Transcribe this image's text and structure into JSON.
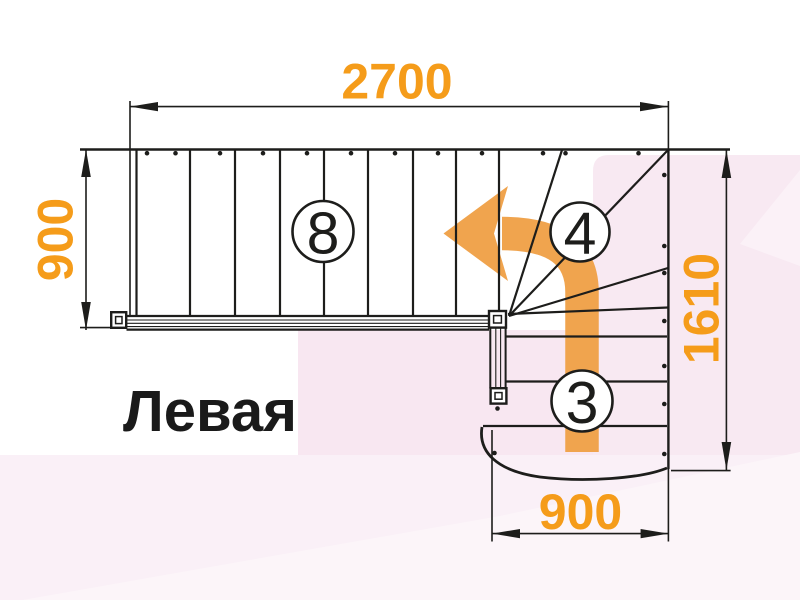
{
  "diagram": {
    "type": "stair-floor-plan",
    "title": "Левая",
    "dimensions": {
      "top": {
        "value": "2700",
        "unit": "mm",
        "orientation": "horizontal"
      },
      "left": {
        "value": "900",
        "unit": "mm",
        "orientation": "vertical"
      },
      "right": {
        "value": "1610",
        "unit": "mm",
        "orientation": "vertical"
      },
      "bottom": {
        "value": "900",
        "unit": "mm",
        "orientation": "horizontal"
      }
    },
    "step_counts": [
      {
        "flight": "upper-straight-flight",
        "label": "8"
      },
      {
        "flight": "winder-turn",
        "label": "4"
      },
      {
        "flight": "lower-straight-flight",
        "label": "3"
      }
    ],
    "arrow": {
      "icon": "turn-left-arrow",
      "meaning": "direction of travel up the stair"
    },
    "colors": {
      "dimension_text": "#F59C1A",
      "arrow_orange": "#F0A44E",
      "line_ink": "#1D1D1B",
      "pink_panel": "#F8E9F2",
      "pink_block": "#F8E7F1",
      "pink_band": "#FAF0F7",
      "pink_light": "#FCF5F9",
      "pink_soft": "#FBF1F7"
    }
  }
}
